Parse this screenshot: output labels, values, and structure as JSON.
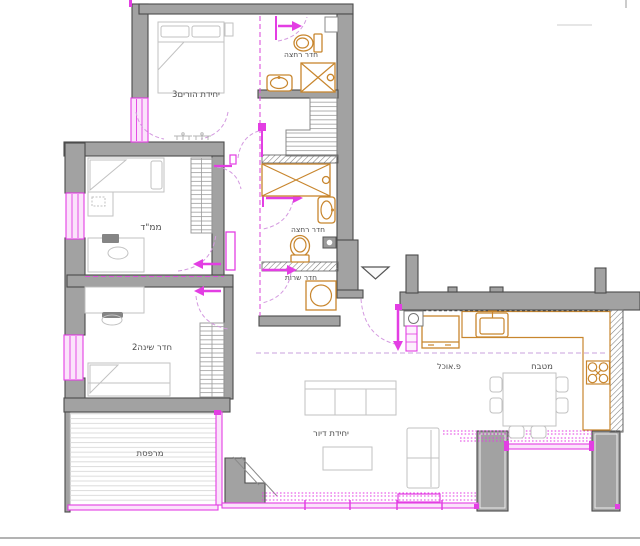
{
  "meta": {
    "type": "architectural-floor-plan",
    "language": "he"
  },
  "colors": {
    "wall_fill": "#a2a2a2",
    "wall_stroke": "#4c4c4c",
    "new_work_magenta": "#e33ee3",
    "door_swing_lavender": "#d49ae0",
    "fixture_orange": "#c8862e",
    "furniture_gray": "#c2c2c2",
    "label_gray": "#4d4d4d"
  },
  "rooms": {
    "parents_unit": {
      "label": "יחידת הורים3"
    },
    "bath_top": {
      "label": "חדר רחצה"
    },
    "mamad": {
      "label": "ממ\"ד"
    },
    "bath_mid": {
      "label": "חדר רחצה"
    },
    "service": {
      "label": "חדר שרות"
    },
    "bedroom2": {
      "label": "חדר שינה2"
    },
    "balcony": {
      "label": "מרפסת"
    },
    "dining": {
      "label": "פ.אוכל"
    },
    "kitchen": {
      "label": "מטבח"
    },
    "living": {
      "label": "יחידת דיור"
    }
  },
  "icons": [
    "toilet-icon",
    "shower-icon",
    "sink-icon",
    "washing-machine-icon",
    "kitchen-sink-icon",
    "stove-icon",
    "entrance-arrow-icon",
    "door-swing-arc",
    "window-marker",
    "wardrobe-hatch"
  ]
}
